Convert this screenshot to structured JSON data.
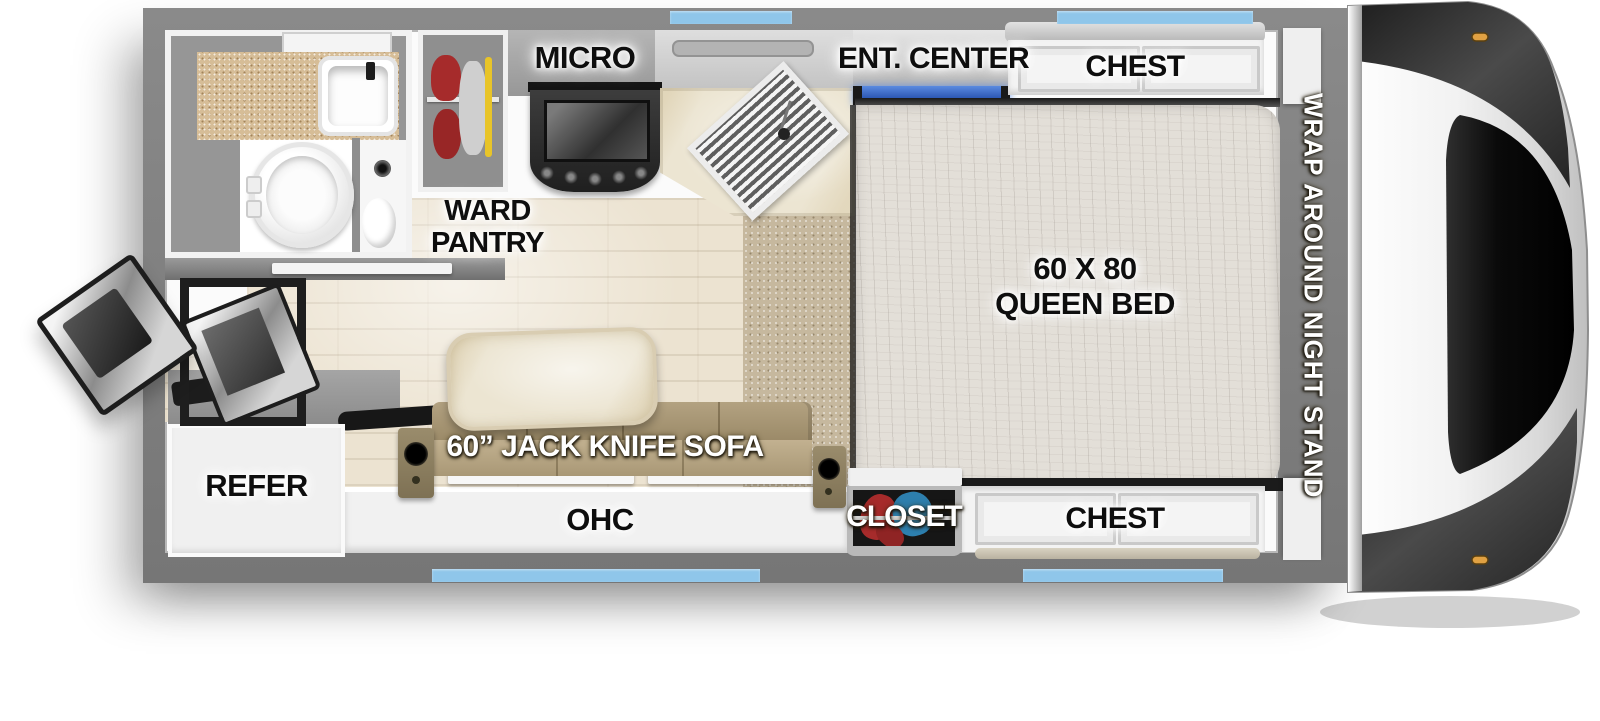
{
  "diagram": {
    "title": "Truck camper floor plan",
    "labels": {
      "micro": "MICRO",
      "ent_center": "ENT. CENTER",
      "chest_top": "CHEST",
      "ward_line1": "WARD",
      "ward_line2": "PANTRY",
      "bed_line1": "60 X 80",
      "bed_line2": "QUEEN BED",
      "night_stand": "WRAP AROUND NIGHT STAND",
      "refer": "REFER",
      "sofa": "60” JACK KNIFE SOFA",
      "ohc": "OHC",
      "closet": "CLOSET",
      "chest_bottom": "CHEST"
    },
    "colors": {
      "wall_gray": "#7e7e7e",
      "window_accent_blue": "#8fc6ea",
      "tv_screen_blue": "#2c57c8",
      "carpet_tan": "#c6b89e",
      "wood_floor": "#ece3d1",
      "mattress": "#e3dfd8",
      "sofa_tan": "#ab9a78",
      "counter_marble": "#ece5d2",
      "bath_counter_tan": "#d6bd97",
      "closet_interior": "#161616",
      "clothes_red": "#a62b2b",
      "clothes_blue": "#2d7fae",
      "front_cap_dark": "#2e2e2e",
      "marker_light_amber": "#e0a143"
    }
  }
}
